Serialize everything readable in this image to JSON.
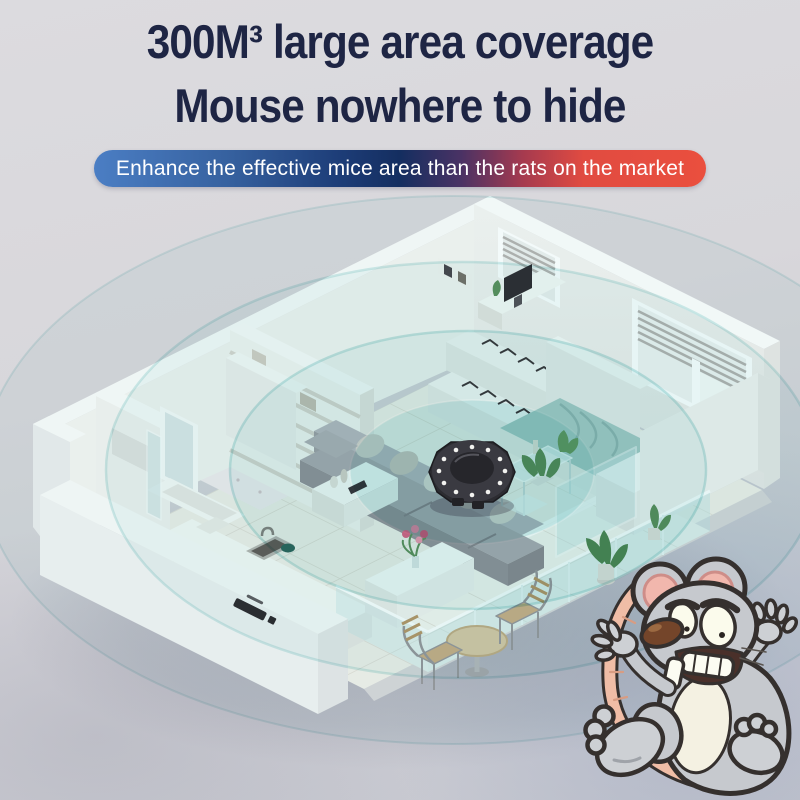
{
  "title": {
    "line1": "300M³ large area coverage",
    "line2": "Mouse nowhere to hide",
    "color": "#1e2544"
  },
  "banner": {
    "text": "Enhance the effective mice area than the rats on the market",
    "text_color": "#ffffff",
    "gradient_left": "#4b7ec4",
    "gradient_mid": "#142e60",
    "gradient_right": "#ea4f3e"
  },
  "scene": {
    "coverage_rings": {
      "count": 4,
      "tint_color": "#8fd2d0"
    },
    "device": {
      "label": "ultrasonic-repeller-device",
      "body_color": "#2c2c31",
      "led_color": "#ffffff"
    },
    "mouse": {
      "label": "scared-cartoon-mouse",
      "body_color": "#c6c9ce",
      "ear_color": "#f1b7ad",
      "tail_color": "#f0bda6"
    },
    "colors": {
      "background": "#d8d7db",
      "walls": "#f4f3f1",
      "floor": "#f2f0ea",
      "sofa": "#a8a8ae",
      "bed_blanket": "#a9cdc9",
      "glass": "#cde8e9"
    }
  }
}
